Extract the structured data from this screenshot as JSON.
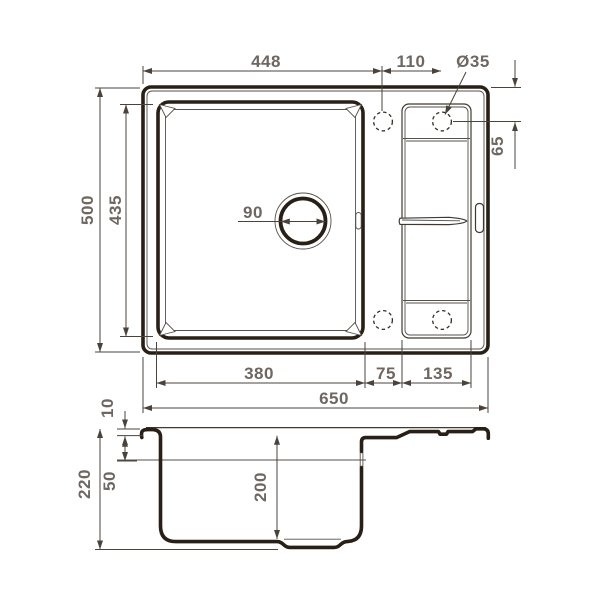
{
  "drawing": {
    "kind": "sink-dimension-drawing",
    "line_color": "#281f17",
    "dimension_color": "#6e6761"
  },
  "dims": {
    "top_width_to_tap": "448",
    "tap_hole_spacing": "110",
    "tap_hole_diameter": "Ø35",
    "overall_depth": "500",
    "bowl_length": "435",
    "edge_to_tap_center": "65",
    "drain_diameter": "90",
    "bowl_width": "380",
    "ledge_width": "75",
    "wing_width": "135",
    "overall_width": "650",
    "rim_height": "10",
    "overflow_level": "50",
    "overall_height": "220",
    "bowl_depth": "200"
  }
}
